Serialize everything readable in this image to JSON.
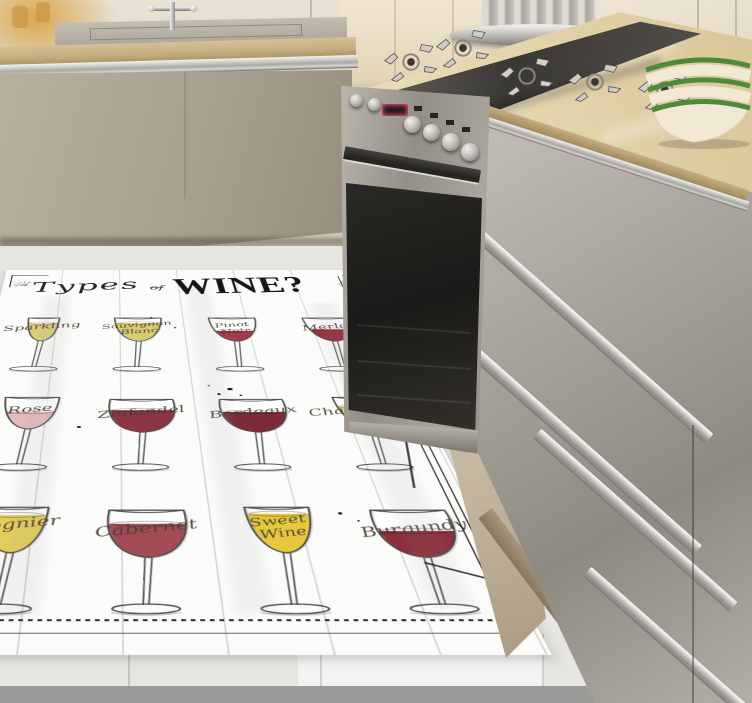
{
  "rug": {
    "title": {
      "types": "Types",
      "of": "of",
      "wine": "WINE?"
    },
    "glasses": [
      {
        "name": "Sparkling",
        "variant": "flute",
        "color": "#ddcf7c",
        "fill": 0.78
      },
      {
        "name": "Sauvignon Blanc",
        "variant": "tulip",
        "color": "#d8cb74",
        "fill": 0.8
      },
      {
        "name": "Pinot Noir",
        "variant": "tulip",
        "color": "#a63c48",
        "fill": 0.45
      },
      {
        "name": "Merlot",
        "variant": "tulip",
        "color": "#96303d",
        "fill": 0.52
      },
      {
        "name": "Rose",
        "variant": "tulip",
        "color": "#e7b9bd",
        "fill": 0.55
      },
      {
        "name": "Zinfandel",
        "variant": "balloon",
        "color": "#8e3545",
        "fill": 0.68
      },
      {
        "name": "Bordeaux",
        "variant": "balloon",
        "color": "#7d2b38",
        "fill": 0.62
      },
      {
        "name": "Chardonnay",
        "variant": "tulip",
        "color": "#e2cd66",
        "fill": 0.72
      },
      {
        "name": "Viognier",
        "variant": "tulip",
        "color": "#e5cf5c",
        "fill": 0.85
      },
      {
        "name": "Cabernet",
        "variant": "balloon",
        "color": "#a34b55",
        "fill": 0.72
      },
      {
        "name": "Sweet Wine",
        "variant": "tulip",
        "color": "#e7c83c",
        "fill": 0.88
      },
      {
        "name": "Burgundy",
        "variant": "balloon",
        "color": "#8d2f3a",
        "fill": 0.56
      }
    ]
  },
  "palette": {
    "wall": "#ddd3c1",
    "countertop": "#e4d5ae",
    "counter_wood_edge": "#b89e74",
    "cabinet_taupe": "#aba293",
    "steel_drawers": "#a6a29a",
    "floor": "#e6e5e2",
    "floor_dark_strip": "#9b9b99",
    "rug_base": "#fbfbf9",
    "ink": "#2a2a2a",
    "bowl_rim_green": "#4e8a3c",
    "bowl_cream": "#f2e9d4",
    "oven_display_glow": "#ff5070",
    "plinth_tan": "#9a8a70"
  },
  "icons": {
    "starburst": "radiating-lines-burst",
    "sparkle": "small-lines-burst",
    "burner_grate": "gas-burner-grate",
    "faucet": "kitchen-faucet",
    "wine_glass": "stemmed-wine-glass",
    "bowl_stack": "stacked-green-rim-bowls"
  }
}
